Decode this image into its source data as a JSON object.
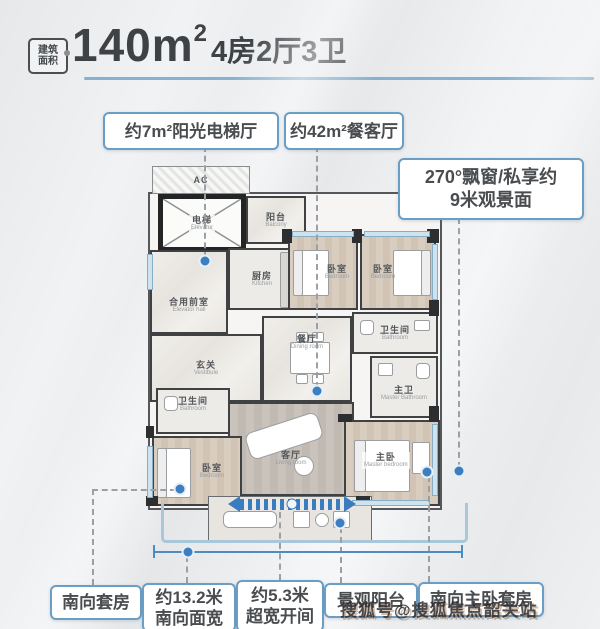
{
  "title": {
    "badge": [
      "建筑",
      "面积"
    ],
    "area": "140m",
    "area_sup": "2",
    "spec": "4房2厅3卫"
  },
  "callouts": {
    "sunlit_elevator_hall": "约7m²阳光电梯厅",
    "dining_living": "约42m²餐客厅",
    "bay_window": [
      "270°飘窗/私享约",
      "9米观景面"
    ],
    "south_suite": "南向套房",
    "south_width": [
      "约13.2米",
      "南向面宽"
    ],
    "wide_opening": [
      "约5.3米",
      "超宽开间"
    ],
    "view_balcony": "景观阳台",
    "south_master_suite": "南向主卧套房"
  },
  "rooms": {
    "ac": {
      "zh": "AC"
    },
    "elevator": {
      "zh": "电梯",
      "en": "Elevator"
    },
    "service_balcony": {
      "zh": "阳台",
      "en": "Balcony"
    },
    "kitchen": {
      "zh": "厨房",
      "en": "Kitchen"
    },
    "elevator_hall": {
      "zh": "合用前室",
      "en": "Elevator hall"
    },
    "vestibule": {
      "zh": "玄关",
      "en": "Vestibule"
    },
    "dining": {
      "zh": "餐厅",
      "en": "Dining room"
    },
    "living": {
      "zh": "客厅",
      "en": "Living room"
    },
    "bedroom_a": {
      "zh": "卧室",
      "en": "Bedroom"
    },
    "bedroom_b": {
      "zh": "卧室",
      "en": "Bedroom"
    },
    "bathroom_right": {
      "zh": "卫生间",
      "en": "Bathroom"
    },
    "master_bath": {
      "zh": "主卫",
      "en": "Master Bathroom"
    },
    "master_bedroom": {
      "zh": "主卧",
      "en": "Master bedroom"
    },
    "bathroom_left": {
      "zh": "卫生间",
      "en": "Bathroom"
    },
    "bedroom_c": {
      "zh": "卧室",
      "en": "Bedroom"
    }
  },
  "watermark": "搜狐号@搜狐焦点韶关站",
  "colors": {
    "callout_border": "#6b9ec4",
    "leader_dot": "#3b7fc2",
    "dimension_line": "#4a8cc4",
    "stripe_arrow": "#3a7cc0",
    "title_underline": "#86b1d0",
    "wall": "#2c2e30",
    "window": "#cfe3ee",
    "facade_highlight": "#a9c7db",
    "background": "#e9ebed"
  }
}
